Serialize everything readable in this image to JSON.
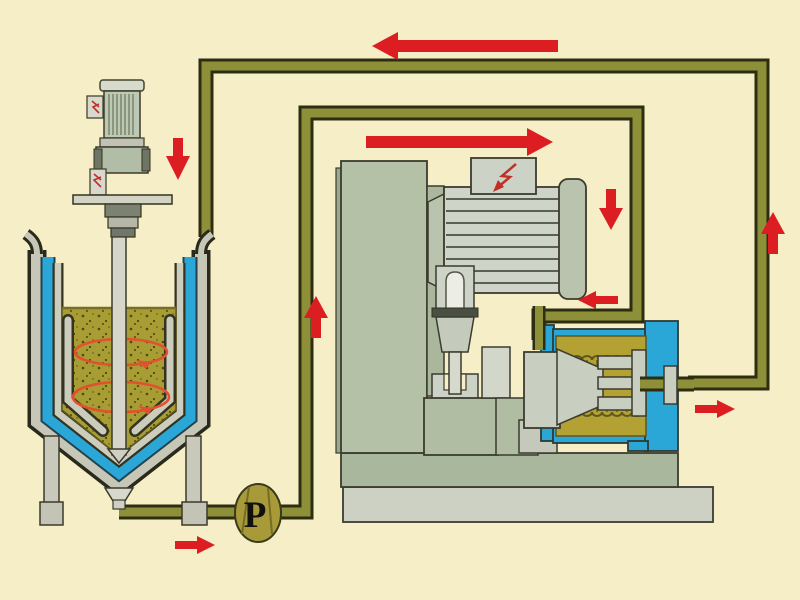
{
  "pump": {
    "label": "P"
  },
  "palette": {
    "background": "#f6eec7",
    "pipe": "#8d9038",
    "pipe_outline": "#2d2d12",
    "tank_jacket_blue": "#2ba7d7",
    "slurry_olive": "#a79d33",
    "chamber_product_olive": "#b3a233",
    "machine_green": "#b4c1a7",
    "machine_light_gray": "#ced4c7",
    "pump_gold": "#a89a38",
    "arrow_red": "#dc1e23",
    "circulation_orange": "#e2512e"
  },
  "components": {
    "tank": "jacketed-mixing-tank",
    "agitator": "top-entry-agitator-motor",
    "pump": "circulation-pump",
    "mill": "horizontal-bead-mill",
    "mill_motor": "mill-drive-motor",
    "chamber": "grinding-chamber"
  },
  "flow_arrows": [
    {
      "location": "top-return-line",
      "direction": "left",
      "size": "large"
    },
    {
      "location": "feed-line-top",
      "direction": "right",
      "size": "large"
    },
    {
      "location": "tank-return-inlet",
      "direction": "down",
      "size": "small"
    },
    {
      "location": "mill-inlet-drop",
      "direction": "down",
      "size": "small"
    },
    {
      "location": "mill-inlet",
      "direction": "left",
      "size": "small"
    },
    {
      "location": "mill-outlet",
      "direction": "right",
      "size": "small"
    },
    {
      "location": "return-riser",
      "direction": "up",
      "size": "small"
    },
    {
      "location": "pump-riser",
      "direction": "up",
      "size": "small"
    },
    {
      "location": "pump-suction-line",
      "direction": "right",
      "size": "small"
    }
  ]
}
